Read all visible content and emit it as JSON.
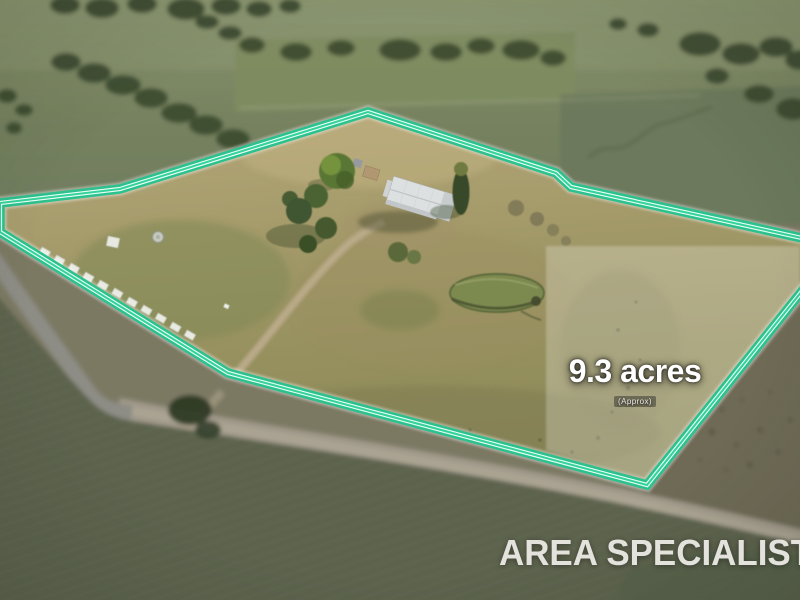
{
  "overlay": {
    "area_label": "9.3 acres",
    "area_qualifier": "(Approx)",
    "colors": {
      "boundary_green_outer": "#2CC18E",
      "boundary_green_inner": "#34D39C",
      "boundary_white": "#ECFFF6",
      "area_text": "#FFFFFF",
      "watermark_text": "#ECEAE5"
    }
  },
  "watermark": {
    "brand": "AREA SPECIALIST"
  }
}
